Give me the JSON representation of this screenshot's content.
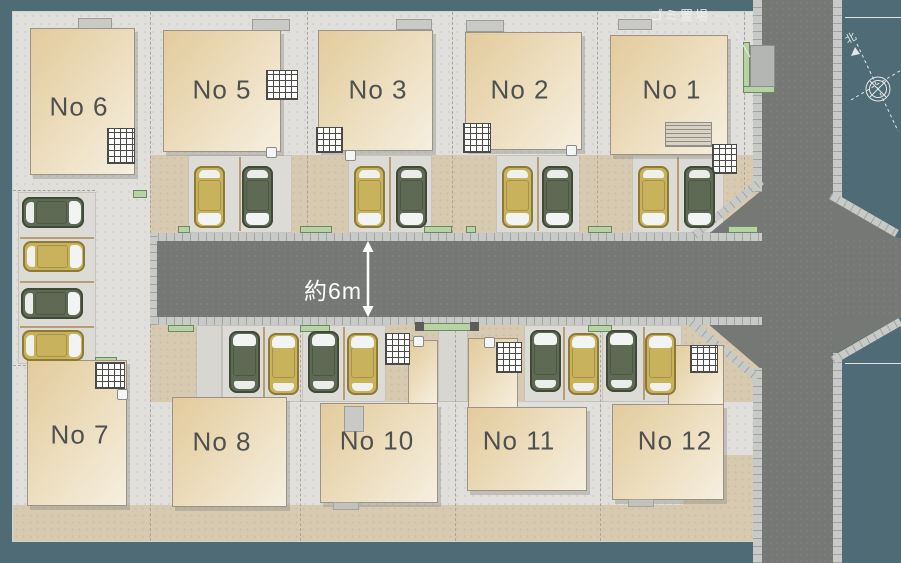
{
  "annotations": {
    "road_width": "約6m",
    "trash_area": "ゴミ置場",
    "north": "北"
  },
  "lots": [
    {
      "id": "no-6",
      "label": "No 6"
    },
    {
      "id": "no-5",
      "label": "No 5"
    },
    {
      "id": "no-3",
      "label": "No 3"
    },
    {
      "id": "no-2",
      "label": "No 2"
    },
    {
      "id": "no-1",
      "label": "No 1"
    },
    {
      "id": "no-7",
      "label": "No 7"
    },
    {
      "id": "no-8",
      "label": "No 8"
    },
    {
      "id": "no-10",
      "label": "No 10"
    },
    {
      "id": "no-11",
      "label": "No 11"
    },
    {
      "id": "no-12",
      "label": "No 12"
    }
  ],
  "colors": {
    "teal": "#4e6b76",
    "road": "#767876",
    "curb": "#c8cac7",
    "curb_line": "#a2a4a1",
    "lot": "#e0dfdb",
    "beige": "#d7cab1",
    "house_light": "#f6efe0",
    "house_dark": "#e3cb9c",
    "house_border": "#9b9486",
    "car_gold": "#c9b25c",
    "car_gold_line": "#8c7a38",
    "car_green": "#5e6a54",
    "car_green_line": "#3f4a39",
    "green_strip": "#b7d3a5",
    "green_strip_line": "#6d8a5e",
    "label_text": "#4f5050",
    "white": "#f2f4f3"
  }
}
